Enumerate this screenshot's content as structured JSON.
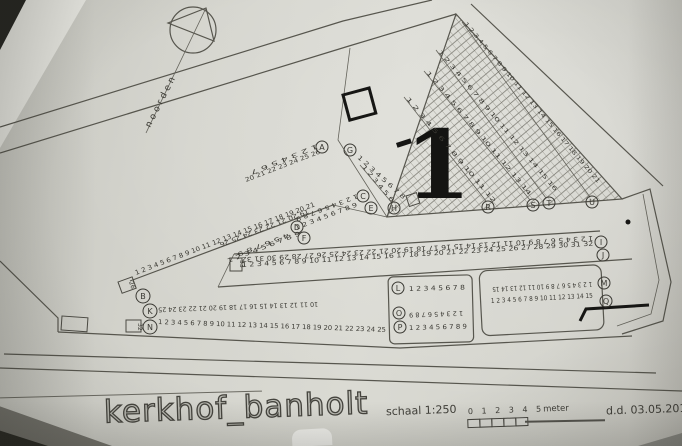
{
  "title": {
    "name": "kerkhof_banholt",
    "scale": "schaal 1:250",
    "date": "d.d. 03.05.2016"
  },
  "scalebar": {
    "ticks": "0 1 2 3 4 5",
    "unit": "meter"
  },
  "compass": {
    "label": "noorden"
  },
  "section": {
    "number": "1"
  },
  "plot_labels": {
    "b_end": "26",
    "n_end": "32",
    "i_end": "33"
  },
  "colors": {
    "paper": "#d6d5cf",
    "ink": "#3a3933",
    "bold_ink": "#161614"
  },
  "rows": {
    "A": {
      "letter": "A",
      "upper": "1 2 3 4 5 6 7",
      "lower": "20 21 22 23 24 25 26"
    },
    "B": {
      "letter": "B",
      "upper": "19 20 21 22 23 24 25 26",
      "lower": "1 2 3 4 5 6 7 8 9 10 11 12 13 14 15 16 17 18 19 20 21"
    },
    "C": {
      "letter": "C",
      "numbers": "1 2 3 4 5 6 7 8 9"
    },
    "D": {
      "letter": "D",
      "numbers": "4 5 6 7 8 9"
    },
    "E": {
      "letter": "E",
      "numbers": "1 2 3 4 5 6 7 8 9"
    },
    "F": {
      "letter": "F",
      "numbers": "1 2 3 4 5 6 7 8 9"
    },
    "G": {
      "letter": "G",
      "numbers": "1 2 3 4 5 6 7 8"
    },
    "H": {
      "letter": "H",
      "numbers": "1 2 3 4 5 6"
    },
    "I": {
      "letter": "I",
      "numbers": "1 2 3 4 5 6 7 8 9 10 11 12 13 14 15 16 17 18 19 20 21 22 23 24 25 26 27 28 29 30 31 32"
    },
    "J": {
      "letter": "J",
      "numbers": "1 2 3 4 5 6 7 8 9 10 11 12 13 14 15 16 17 18 19 20 21 22 23 24 25 26 27 28 29 30 31 32"
    },
    "K": {
      "letter": "K",
      "numbers": "10 11 12 13 14 15 16 17 18 19 20 21 22 23 24 25"
    },
    "L": {
      "letter": "L",
      "numbers": "1 2 3 4 5 6 7 8"
    },
    "M": {
      "letter": "M",
      "numbers": "1 2 3 4 5 6 7 8 9 10 11 12 13 14 15"
    },
    "N": {
      "letter": "N",
      "numbers": "1 2 3 4 5 6 7 8 9 10 11 12 13 14 15 16 17 18 19 20 21 22 23 24 25"
    },
    "O": {
      "letter": "O",
      "numbers": "1 2 3 4 5 6 7 8 9"
    },
    "P": {
      "letter": "P",
      "numbers": "1 2 3 4 5 6 7 8 9"
    },
    "Q": {
      "letter": "Q",
      "numbers": "1 2 3 4 5 6 7 8 9 10 11 12 13 14 15"
    },
    "R": {
      "letter": "R",
      "numbers": "1 2 3 4 5 6 7 8 9 10 11 12"
    },
    "S": {
      "letter": "S",
      "numbers": "1 2 3 4 5 6 7 8 9 10 11 12 13 14"
    },
    "T": {
      "letter": "T",
      "numbers": "1 2 3 4 5 6 7 8 9 10 11 12 13 14 15 16"
    },
    "U": {
      "letter": "U",
      "numbers": "1 2 3 4 5 6 7 8 9 10 11 12 13 14 15 16 17 18 19 20 21"
    }
  }
}
